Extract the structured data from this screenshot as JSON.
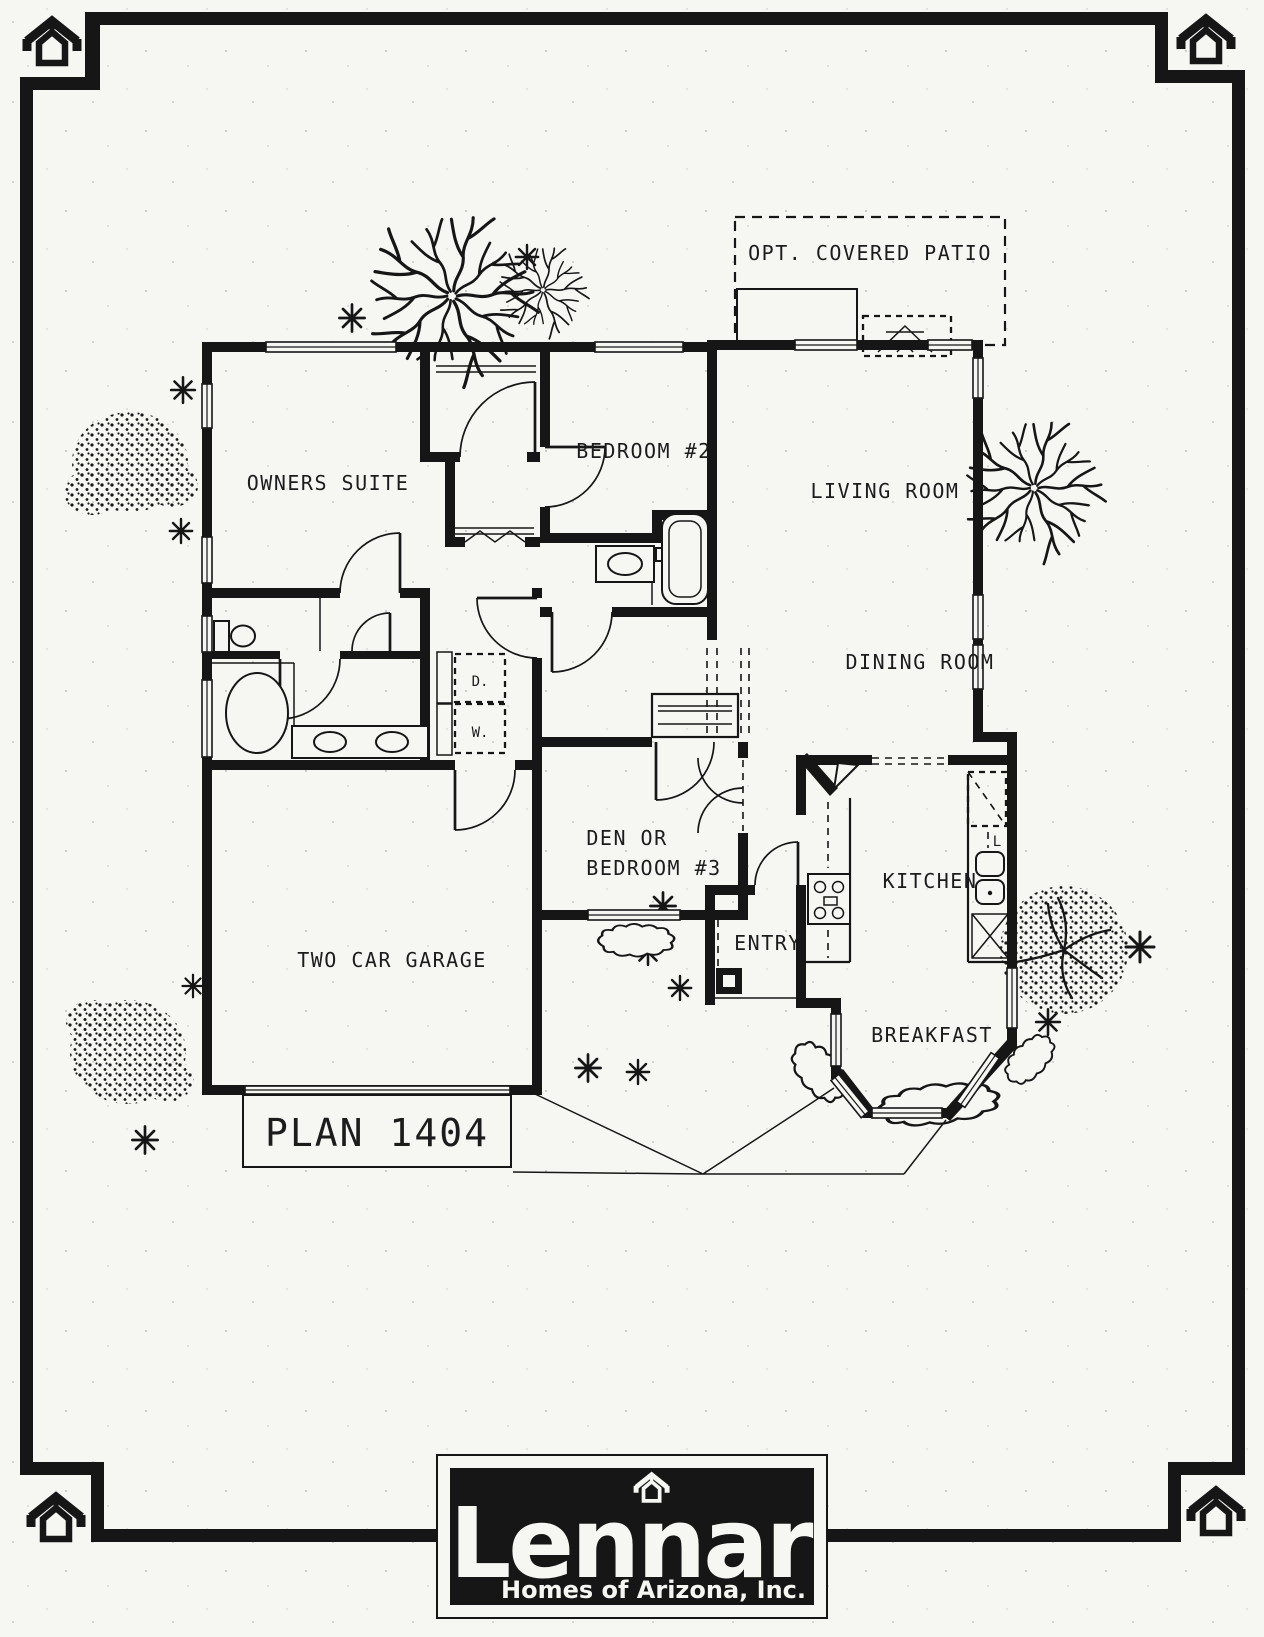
{
  "document": {
    "colors": {
      "paper": "#f6f6f3",
      "ink": "#161616"
    }
  },
  "plan": {
    "patio_label": "OPT. COVERED PATIO",
    "rooms": {
      "owners_suite": "OWNERS SUITE",
      "bedroom_2": "BEDROOM #2",
      "living_room": "LIVING ROOM",
      "dining_room": "DINING ROOM",
      "den_line_1": "DEN OR",
      "den_line_2": "BEDROOM #3",
      "kitchen": "KITCHEN",
      "entry": "ENTRY",
      "breakfast": "BREAKFAST",
      "garage": "TWO CAR GARAGE"
    },
    "appliances": {
      "dryer": "D.",
      "washer": "W.",
      "pantry_mark": "L"
    },
    "plan_number": "PLAN 1404"
  },
  "logo": {
    "brand": "Lennar",
    "tagline": "Homes of Arizona, Inc."
  }
}
